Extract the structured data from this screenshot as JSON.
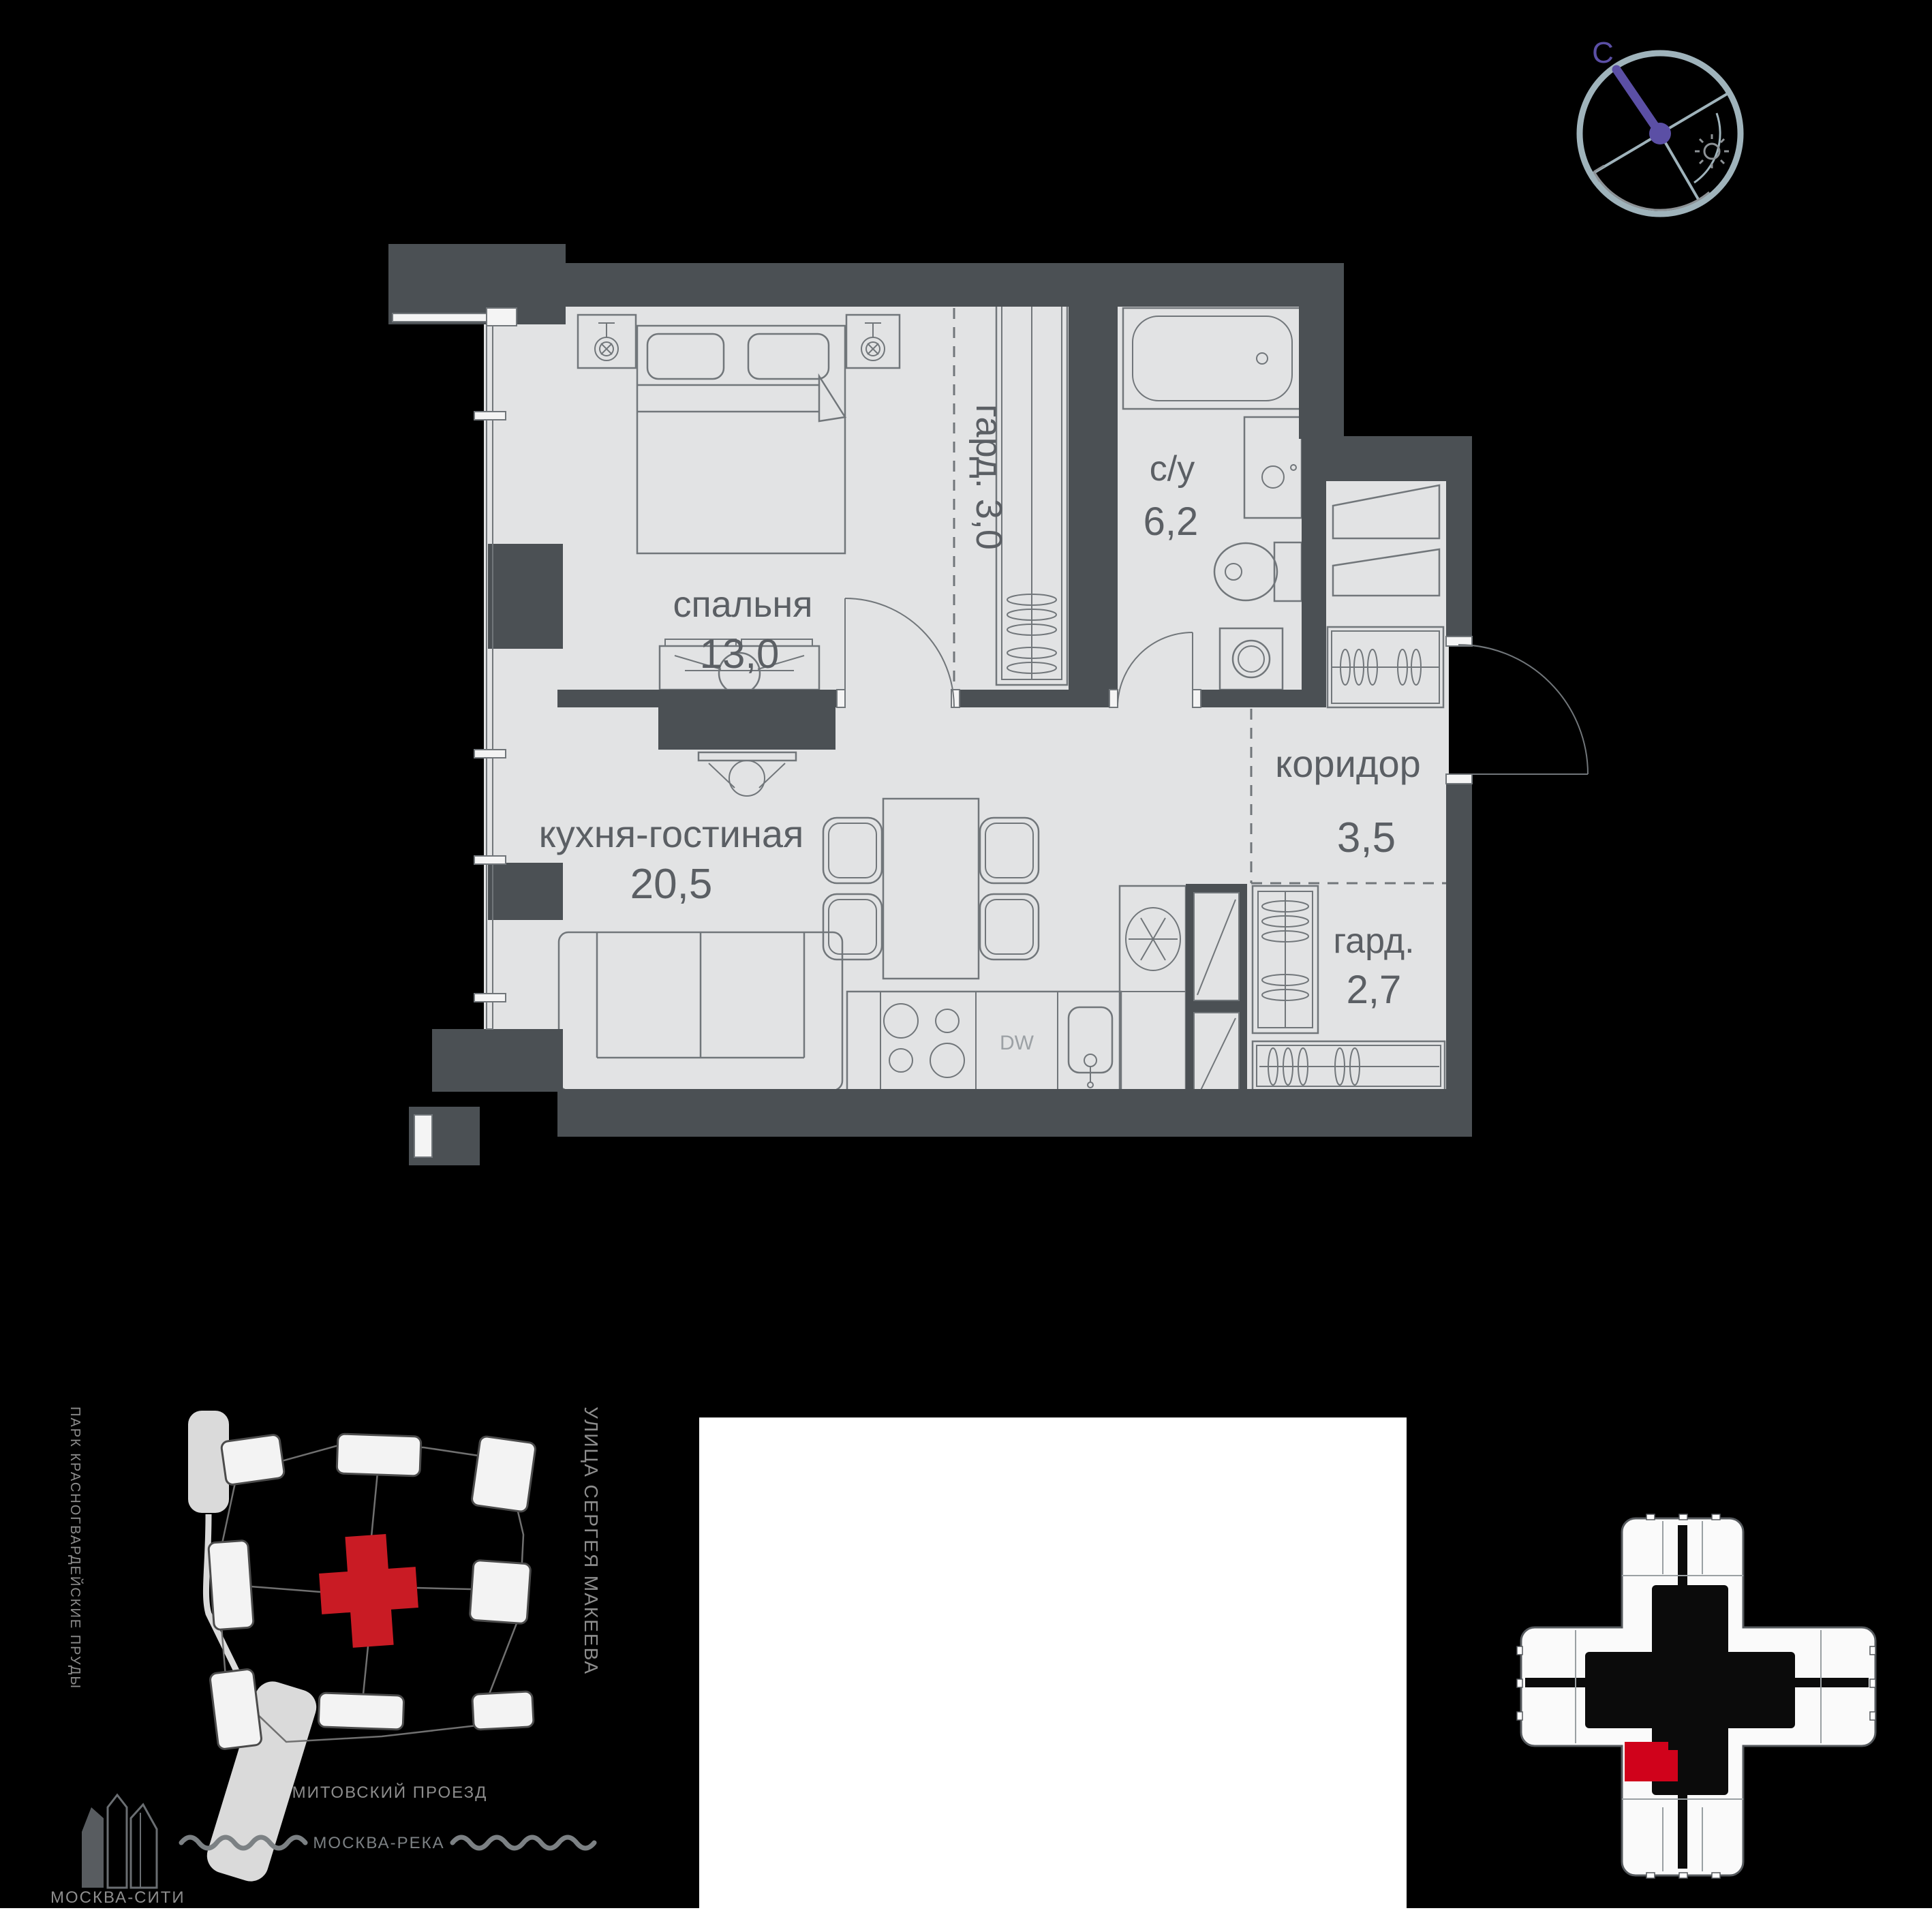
{
  "plan": {
    "wall_color": "#4B5054",
    "floor_color": "#E2E3E4",
    "label_color": "#5B5F64",
    "rooms": {
      "bedroom": {
        "label": "спальня",
        "area": "13,0"
      },
      "wardrobe_top": {
        "label": "гард. 3,0"
      },
      "bathroom": {
        "label": "с/у",
        "area": "6,2"
      },
      "corridor": {
        "label": "коридор",
        "area": "3,5"
      },
      "kitchen_living": {
        "label": "кухня-гостиная",
        "area": "20,5"
      },
      "wardrobe_hall": {
        "label": "гард.",
        "area": "2,7"
      }
    },
    "appliance_labels": {
      "dishwasher": "DW"
    }
  },
  "compass": {
    "north": "С",
    "needle_color": "#5B4FA5",
    "ring_color": "#9FB3BB"
  },
  "location_map": {
    "park_label": "ПАРК КРАСНОГВАРДЕЙСКИЕ ПРУДЫ",
    "street_right_label": "УЛИЦА СЕРГЕЯ МАКЕЕВА",
    "street_bottom_label": "ШМИТОВСКИЙ ПРОЕЗД",
    "river_label": "МОСКВА-РЕКА",
    "city_label": "МОСКВА-СИТИ",
    "building_highlight_color": "#C91B24"
  },
  "floor_keyplan": {
    "unit_highlight_color": "#D0021B"
  }
}
